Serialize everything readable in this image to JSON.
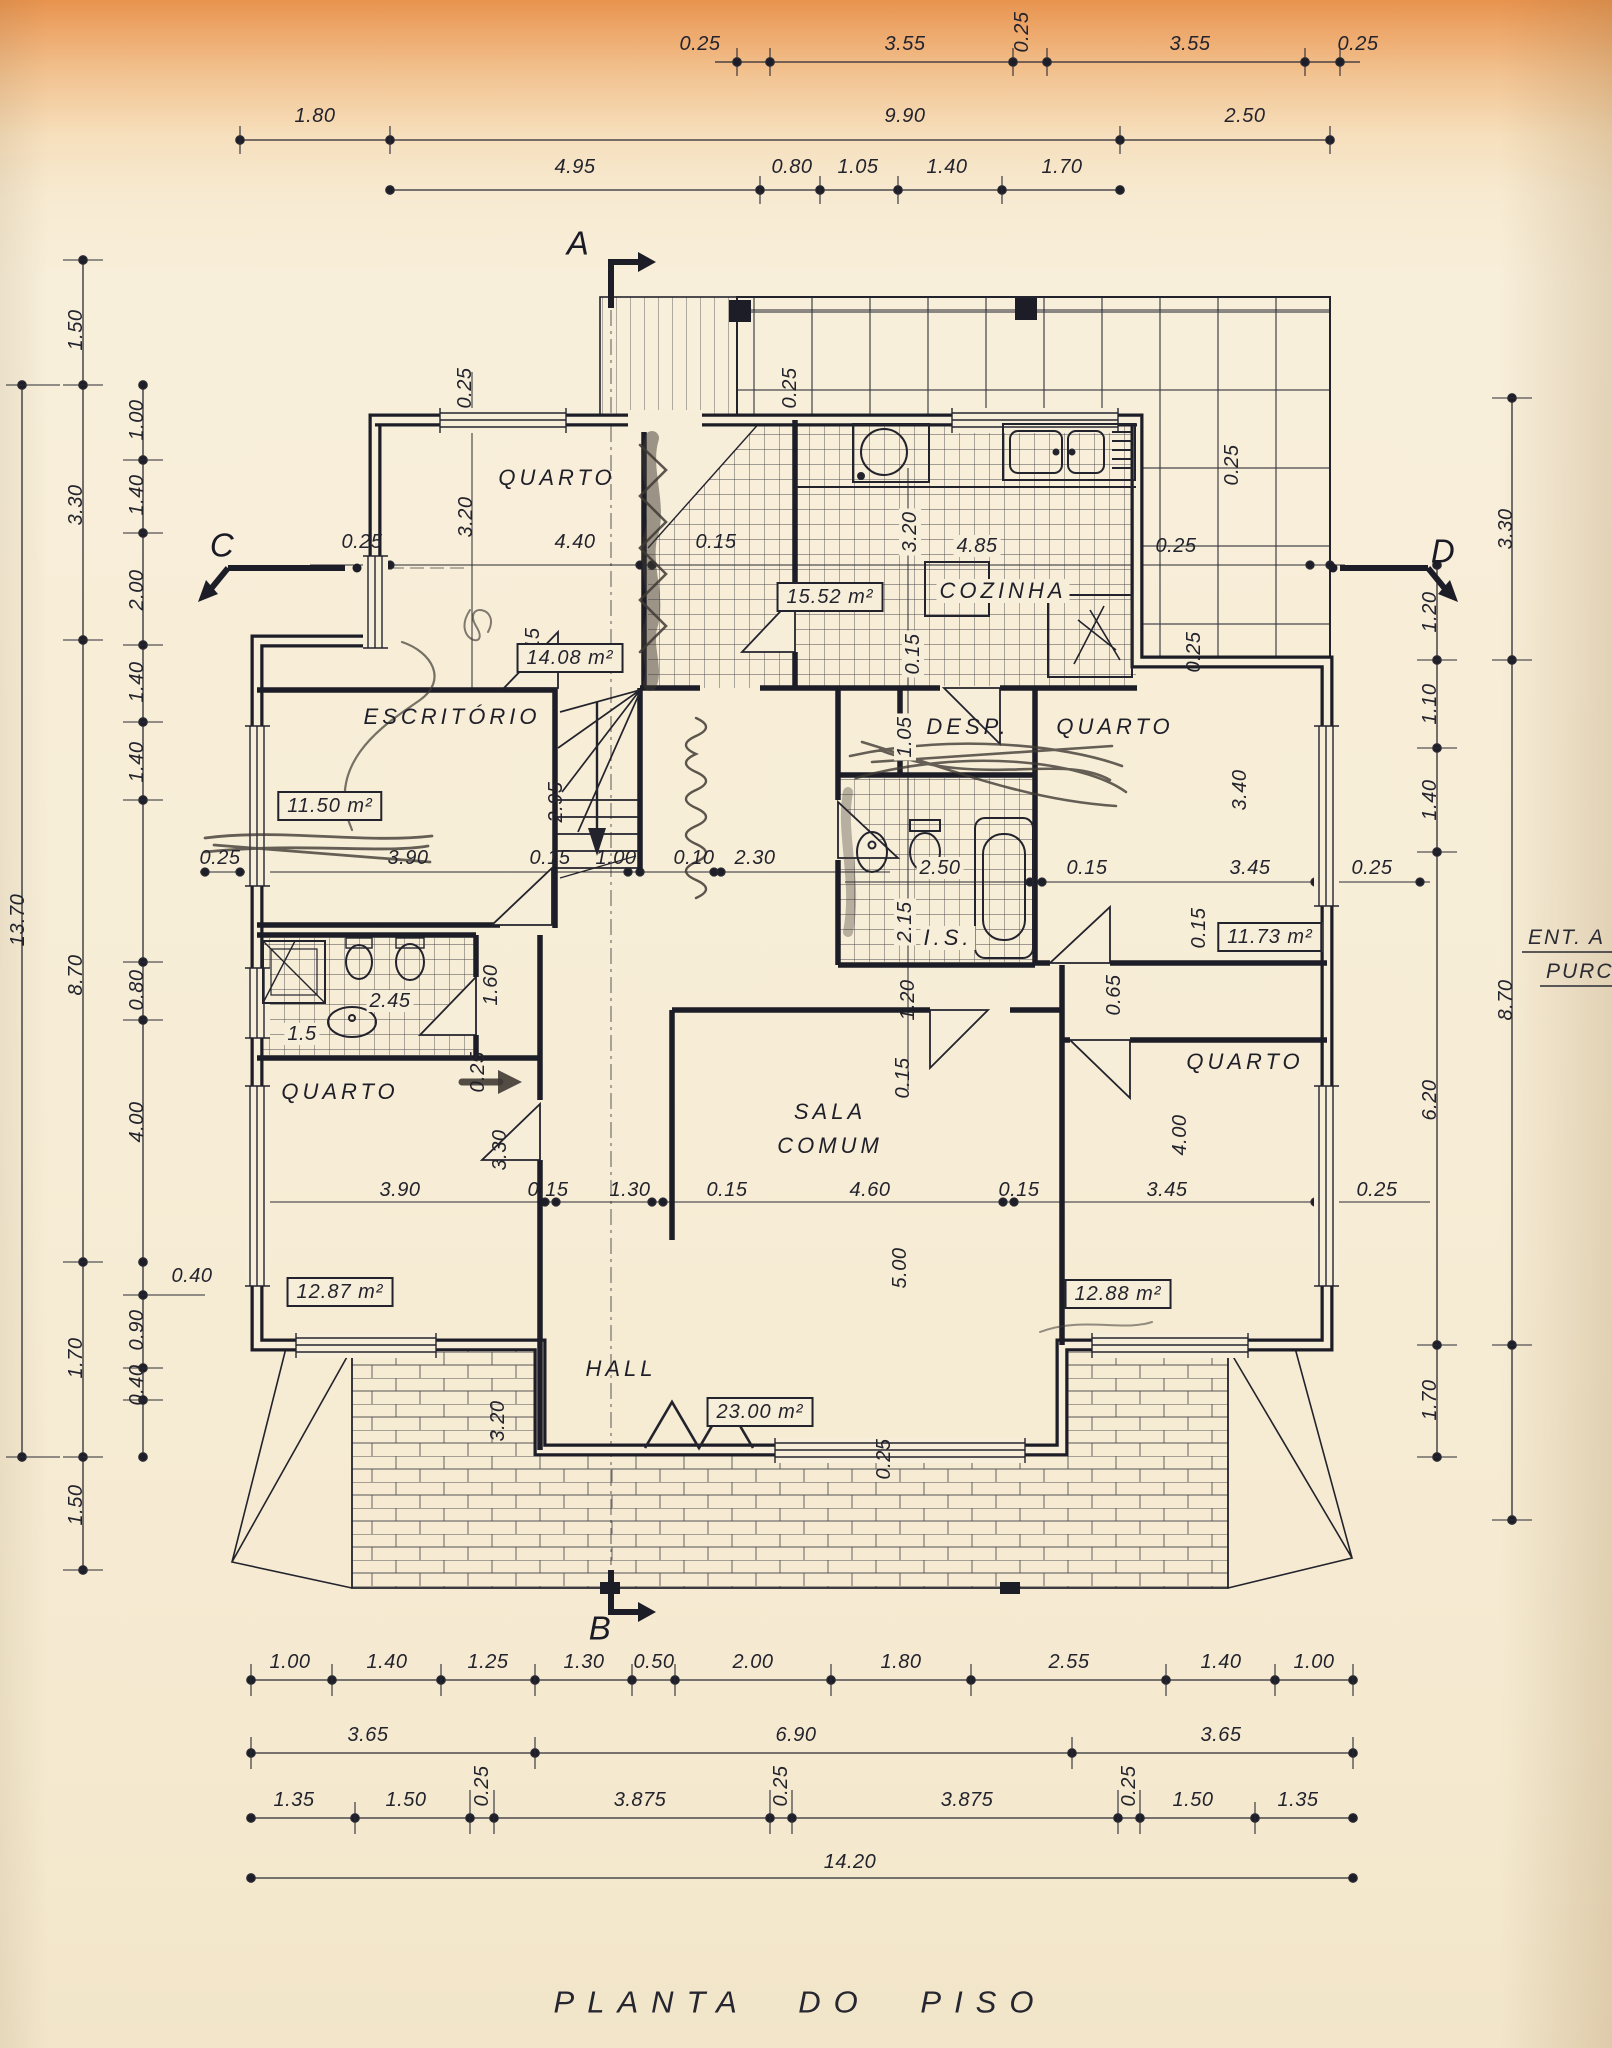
{
  "title": "PLANTA DO PISO",
  "sections": {
    "a": "A",
    "b": "B",
    "c": "C",
    "d": "D"
  },
  "edge_note": {
    "line1": "ENT. A",
    "line2": "PURC"
  },
  "rooms": {
    "quarto_tl": "QUARTO",
    "quarto_tl_area": "14.08 m²",
    "cozinha": "COZINHA",
    "cozinha_area": "15.52 m²",
    "escritorio": "ESCRITÓRIO",
    "escritorio_area": "11.50 m²",
    "despensa": "DESP.",
    "quarto_tr": "QUARTO",
    "quarto_tr_area": "11.73 m²",
    "wc_right": "I.S.",
    "wc_left": "1.5",
    "quarto_bl": "QUARTO",
    "quarto_bl_area": "12.87 m²",
    "sala_line1": "SALA",
    "sala_line2": "COMUM",
    "sala_area": "23.00 m²",
    "quarto_br": "QUARTO",
    "quarto_br_area": "12.88 m²",
    "hall": "HALL"
  },
  "dims": {
    "top_row1": [
      "0.25",
      "3.55",
      "0.25",
      "3.55",
      "0.25"
    ],
    "top_row2": [
      "1.80",
      "9.90",
      "2.50"
    ],
    "top_row3": [
      "4.95",
      "0.80",
      "1.05",
      "1.40",
      "1.70"
    ],
    "bottom_row1": [
      "1.00",
      "1.40",
      "1.25",
      "1.30",
      "0.50",
      "2.00",
      "1.80",
      "2.55",
      "1.40",
      "1.00"
    ],
    "bottom_row2": [
      "3.65",
      "6.90",
      "3.65"
    ],
    "bottom_row3": [
      "1.35",
      "1.50",
      "0.25",
      "3.875",
      "0.25",
      "3.875",
      "0.25",
      "1.50",
      "1.35"
    ],
    "bottom_row4": [
      "14.20"
    ],
    "left_outer": [
      "13.70"
    ],
    "left_mid": [
      "1.50",
      "3.30",
      "8.70",
      "1.70",
      "1.50"
    ],
    "left_inner": [
      "1.00",
      "1.40",
      "2.00",
      "1.40",
      "1.40",
      "0.80",
      "4.00",
      "0.40",
      "0.90",
      "0.40"
    ],
    "right_outer": [
      "3.30",
      "8.70"
    ],
    "right_inner": [
      "1.20",
      "1.10",
      "1.40",
      "6.20",
      "1.70"
    ],
    "interior": [
      "0.25",
      "0.25",
      "3.20",
      "4.40",
      "0.15",
      "0.25",
      "3.20",
      "4.85",
      "0.25",
      "0.25",
      "0.25",
      "0.15",
      "0.15",
      "1.05",
      "3.40",
      "2.95",
      "0.25",
      "3.90",
      "0.15",
      "1.00",
      "0.10",
      "2.30",
      "2.50",
      "0.15",
      "3.45",
      "0.25",
      "2.15",
      "0.15",
      "1.60",
      "2.45",
      "1.20",
      "0.65",
      "0.15",
      "0.25",
      "3.30",
      "4.00",
      "5.00",
      "3.90",
      "0.15",
      "1.30",
      "0.15",
      "4.60",
      "0.15",
      "3.45",
      "0.25",
      "3.20",
      "0.25"
    ]
  }
}
